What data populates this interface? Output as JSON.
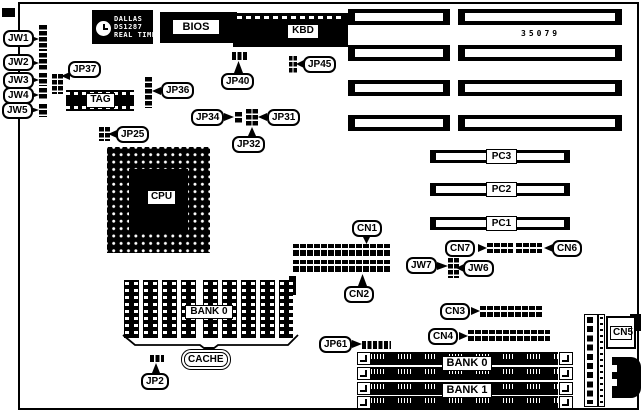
{
  "part_number": "35079",
  "rtc_chip": {
    "line1": "DALLAS",
    "line2": "DS1287",
    "line3": "REAL TIME"
  },
  "chips": {
    "bios": "BIOS",
    "kbd": "KBD",
    "cpu": "CPU",
    "tag": "TAG"
  },
  "jumpers": {
    "jw1": "JW1",
    "jw2": "JW2",
    "jw3": "JW3",
    "jw4": "JW4",
    "jw5": "JW5",
    "jw6": "JW6",
    "jw7": "JW7",
    "jp2": "JP2",
    "jp25": "JP25",
    "jp31": "JP31",
    "jp32": "JP32",
    "jp34": "JP34",
    "jp36": "JP36",
    "jp37": "JP37",
    "jp40": "JP40",
    "jp45": "JP45",
    "jp61": "JP61"
  },
  "connectors": {
    "cn1": "CN1",
    "cn2": "CN2",
    "cn3": "CN3",
    "cn4": "CN4",
    "cn5": "CN5",
    "cn6": "CN6",
    "cn7": "CN7"
  },
  "slots": {
    "pc1": "PC1",
    "pc2": "PC2",
    "pc3": "PC3"
  },
  "memory": {
    "cache_bank": "BANK 0",
    "cache": "CACHE",
    "simm_bank0": "BANK 0",
    "simm_bank1": "BANK 1"
  },
  "colors": {
    "ink": "#000000",
    "paper": "#ffffff"
  }
}
